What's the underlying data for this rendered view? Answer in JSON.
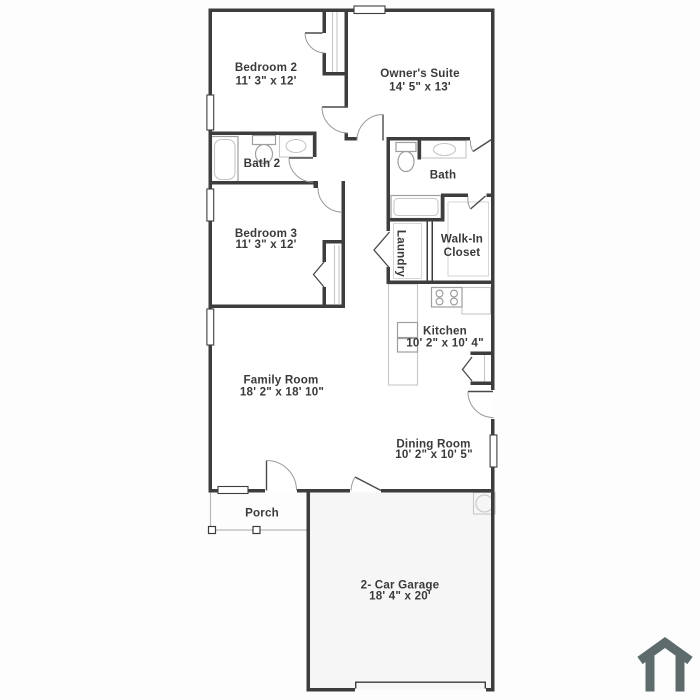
{
  "colors": {
    "wall": "#3d3d3d",
    "text": "#3a3a3a",
    "fixture": "#9e9e9e",
    "fixture_light": "#c6c6c6",
    "porch": "#b8b8b8",
    "logo": "#5e6b6d",
    "background": "#fdfdfd",
    "garage_fill": "#f6f6f6"
  },
  "plan": {
    "rooms": {
      "bedroom2": {
        "name": "Bedroom 2",
        "dims": "11' 3\" x 12'"
      },
      "owners_suite": {
        "name": "Owner's Suite",
        "dims": "14' 5\" x 13'"
      },
      "bath2": {
        "name": "Bath 2"
      },
      "bath": {
        "name": "Bath"
      },
      "bedroom3": {
        "name": "Bedroom 3",
        "dims": "11' 3\" x 12'"
      },
      "laundry": {
        "name": "Laundry"
      },
      "walkin_closet": {
        "line1": "Walk-In",
        "line2": "Closet"
      },
      "kitchen": {
        "name": "Kitchen",
        "dims": "10' 2\" x 10' 4\""
      },
      "family_room": {
        "name": "Family Room",
        "dims": "18' 2\" x 18' 10\""
      },
      "dining_room": {
        "name": "Dining Room",
        "dims": "10' 2\" x 10' 5\""
      },
      "porch": {
        "name": "Porch"
      },
      "garage": {
        "name": "2- Car Garage",
        "dims": "18' 4\" x 20'"
      }
    },
    "icons": {
      "logo": "house-icon"
    }
  }
}
